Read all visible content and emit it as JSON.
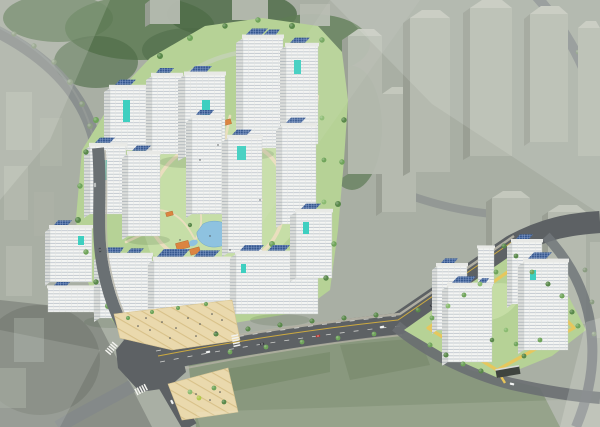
{
  "meta": {
    "description": "Bird's-eye architectural rendering of two new apartment complexes with white solar-roof towers, landscaped courtyards, tree-lined roads and a faded surrounding cityscape"
  },
  "palette": {
    "base": "#a9afa4",
    "wash": "#f3f5f0",
    "forest": "#5e7b55",
    "forest-dark": "#4c6a46",
    "field-faded": "#6f855f",
    "context-face": "#b6bbb0",
    "context-side": "#999f94",
    "context-cap": "#c6cabf",
    "site-green": "#b6d296",
    "court-green": "#c8dfa8",
    "path-beige": "#ecdfc0",
    "plaza": "#ead9ad",
    "plaza-stripe": "#d8c189",
    "road": "#5d6164",
    "road-faded": "#82888a",
    "road-edge": "#b9b7a9",
    "lane-white": "#f2f2ee",
    "lane-yellow": "#d9b33c",
    "tower-face": "#f4f5f3",
    "tower-side": "#dcdedb",
    "tower-window": "#b9c1c9",
    "tower-window-side": "#a9b0b6",
    "roof-cap": "#e8e9e6",
    "solar": "#35578f",
    "solar-grid": "#8aa2cc",
    "teal": "#3ecfc0",
    "pond": "#8ec2e0",
    "pavilion": "#db8440",
    "tree": "#6fa45a",
    "tree-light": "#8abb70",
    "tree-dark": "#59884a",
    "tree-faded": "#8a9c81",
    "blossom": "#dfcbd4",
    "loop-path": "#e9c65a",
    "canopy": "#3f443f",
    "people": "#4a4d4f",
    "car-red": "#b8352f",
    "car-dark": "#3a3d40",
    "car-white": "#eef0ef"
  },
  "scene": {
    "main_complex": {
      "label": "main apartment complex",
      "tower_count": 16,
      "roof_feature": "rooftop solar panel arrays",
      "facade_accent": "teal feature panels",
      "courtyard": [
        "landscaped garden",
        "blue pond",
        "orange-roof pavilions",
        "winding beige paths"
      ]
    },
    "small_complex": {
      "label": "secondary apartment complex",
      "tower_count": 5,
      "feature": "yellow perimeter walking loop"
    },
    "roads": {
      "features": [
        "signalized intersection",
        "zebra crosswalks",
        "yellow center line",
        "tree-lined boulevard",
        "corner plazas with paving pattern",
        "cars"
      ]
    },
    "surroundings": {
      "label": "existing city blocks and wooded hillside",
      "style": "desaturated white-washed context"
    }
  }
}
